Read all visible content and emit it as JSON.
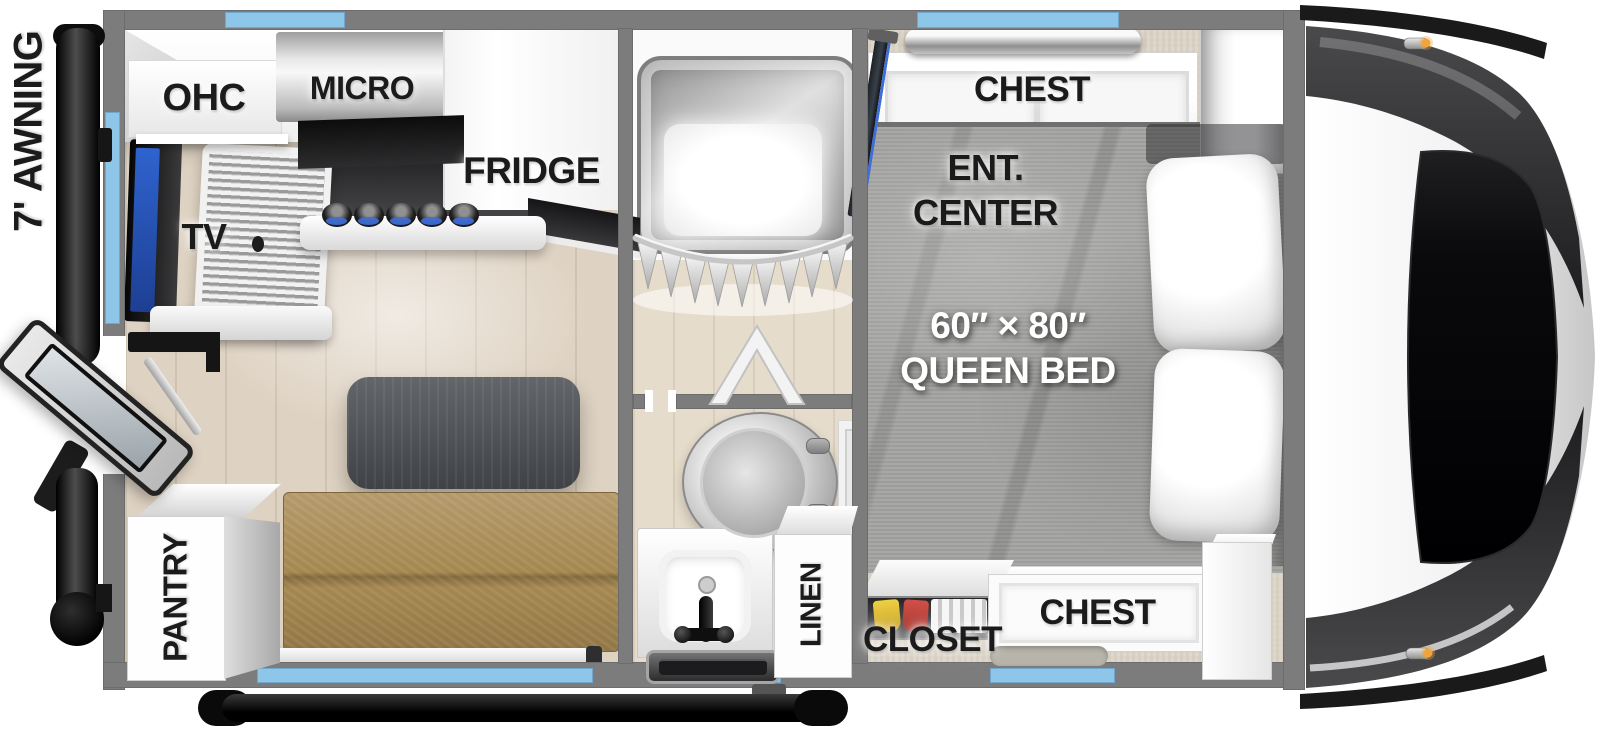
{
  "plan": {
    "awning": "7' AWNING",
    "kitchen": {
      "ohc": "OHC",
      "micro": "MICRO",
      "fridge": "FRIDGE",
      "tv": "TV",
      "pantry": "PANTRY"
    },
    "bath": {
      "linen": "LINEN"
    },
    "bedroom": {
      "chest_top": "CHEST",
      "ent1": "ENT.",
      "ent2": "CENTER",
      "bed1": "60″ × 80″",
      "bed2": "QUEEN BED",
      "closet": "CLOSET",
      "chest_bottom": "CHEST"
    }
  },
  "colors": {
    "wall": "#7c7c7c",
    "window": "#8ec6ea",
    "floor": "#ded2c2",
    "bath_floor": "#e6dccb",
    "carpet": "#dcd5c8",
    "sofa": "#a5874f",
    "table": "#4d5155",
    "bed": "#a3a3a1",
    "label": "#1b1b1b",
    "accent": "#3e6ed8"
  }
}
